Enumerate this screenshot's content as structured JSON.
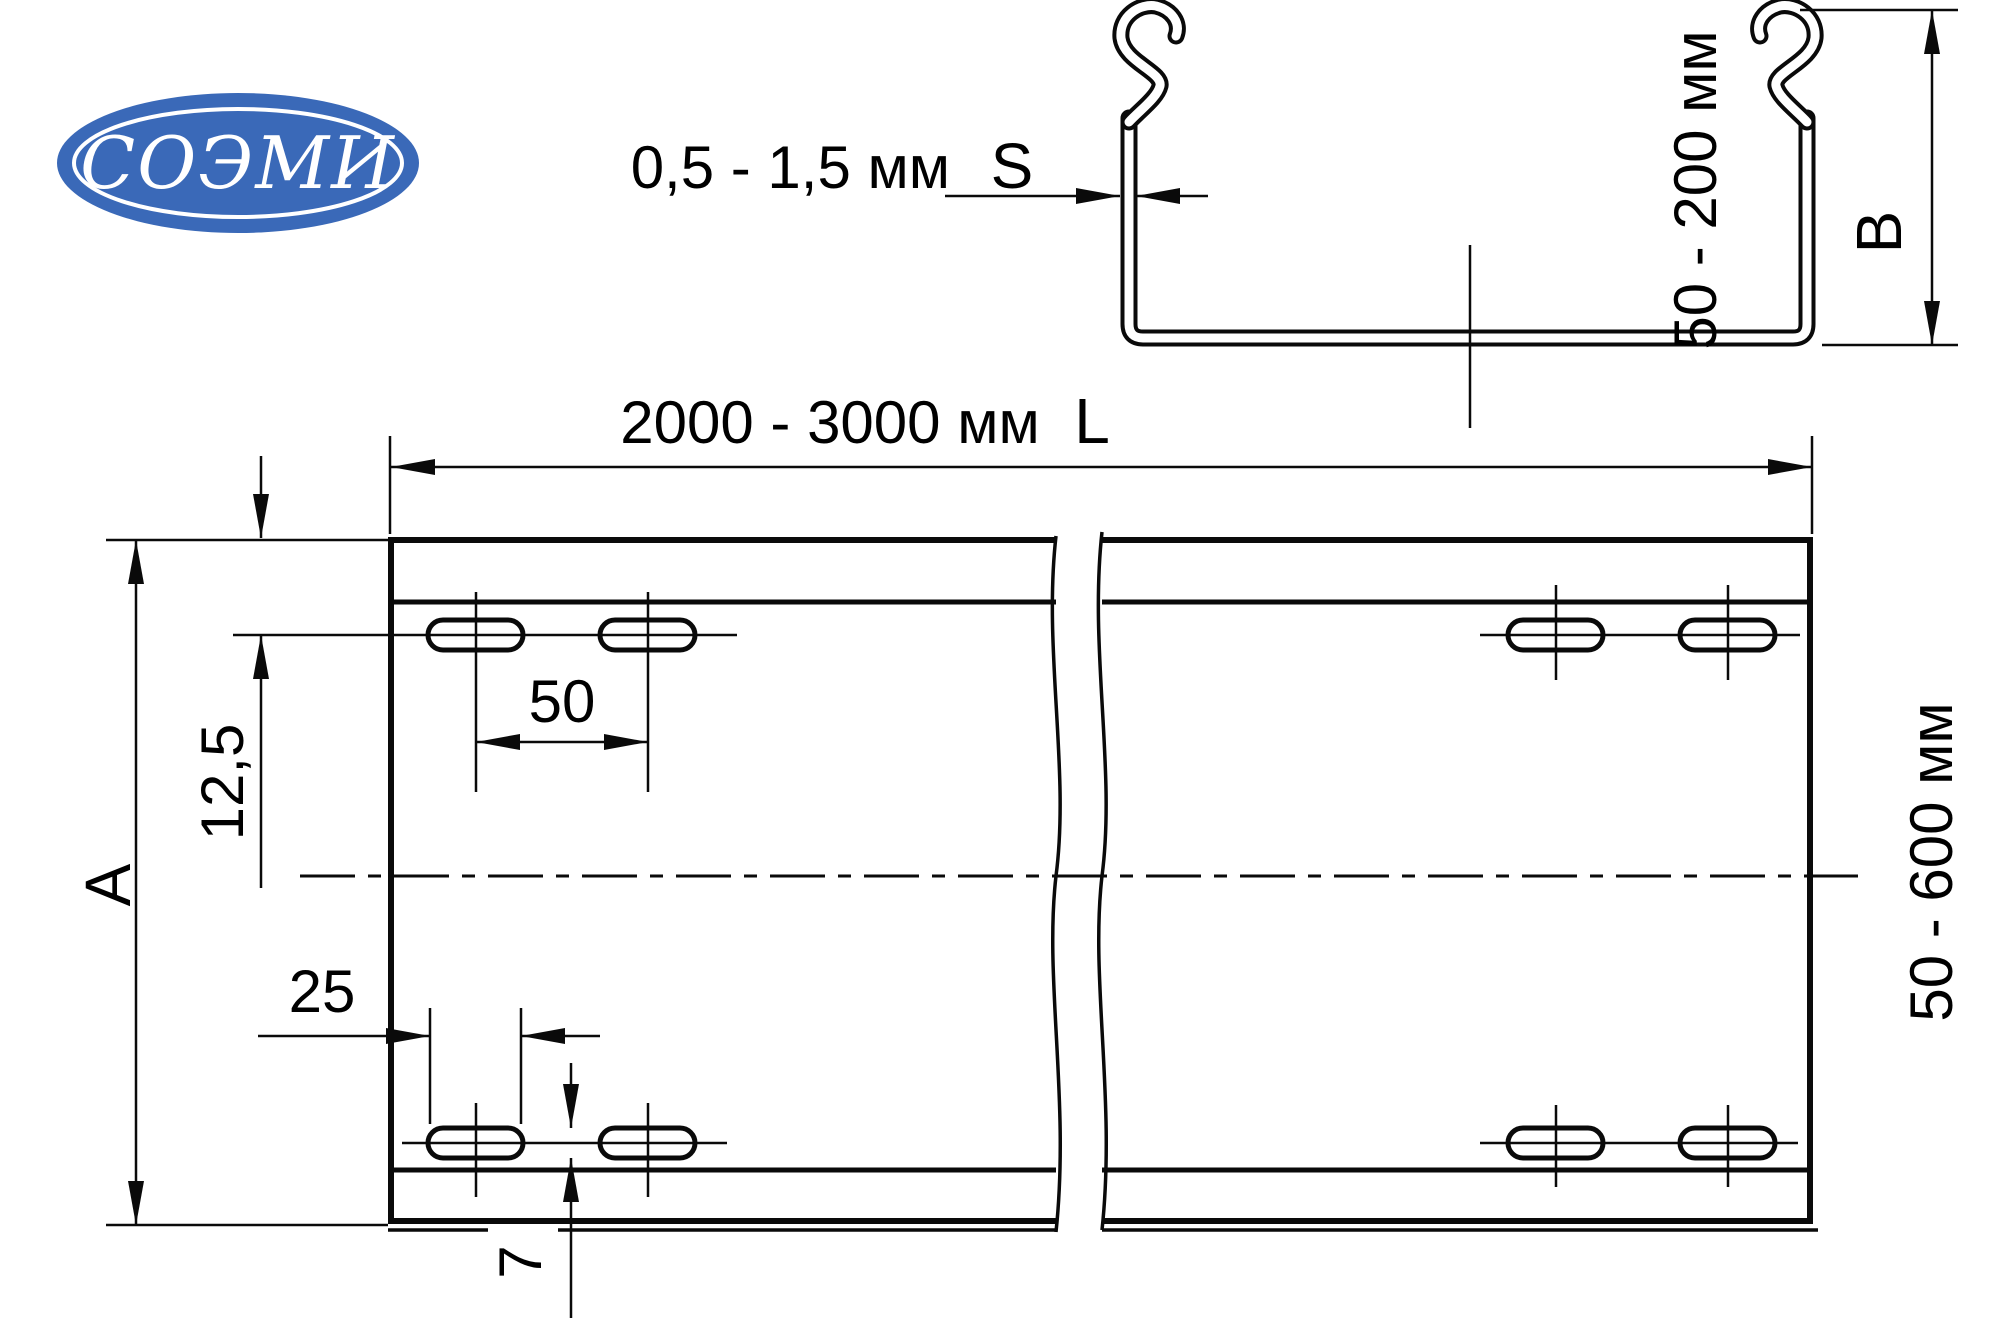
{
  "logo": {
    "text": "СОЭМИ",
    "background_color": "#3a69b8",
    "text_color": "#ffffff"
  },
  "cross_section_view": {
    "thickness_range": "0,5 - 1,5 мм",
    "thickness_letter": "S",
    "height_range": "50 - 200 мм",
    "height_letter": "B"
  },
  "plan_view": {
    "length_range": "2000 - 3000 мм",
    "length_letter": "L",
    "width_letter": "A",
    "width_range": "50 - 600 мм",
    "hole_offset_from_edge": "12,5",
    "hole_pair_pitch": "50",
    "hole_length": "25",
    "hole_width": "7"
  }
}
